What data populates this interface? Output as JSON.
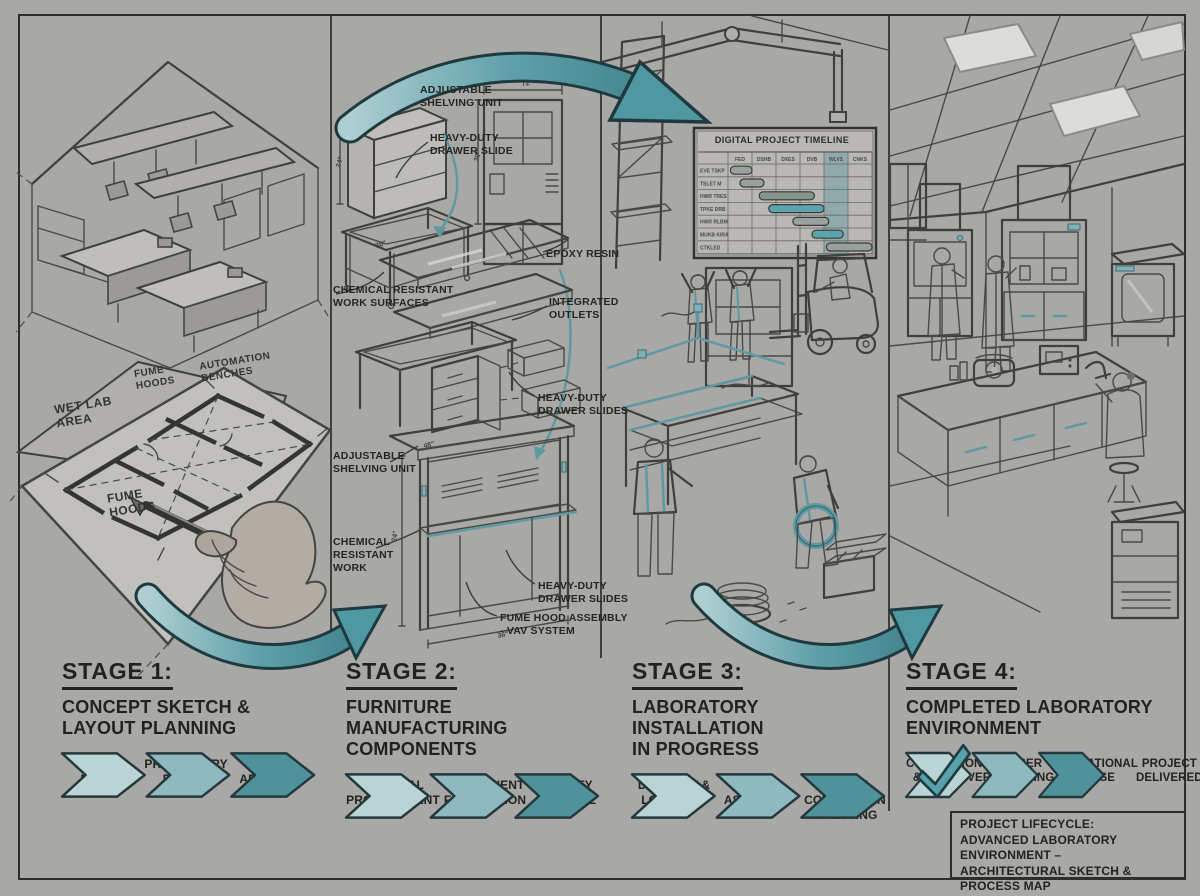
{
  "colors": {
    "background": "#a8a8a6",
    "ink": "#2b2a28",
    "teal": "#4f98a2",
    "teal_light": "#bad4d5",
    "teal_mid": "#8db9bf",
    "teal_dark": "#4f929c"
  },
  "stages": [
    {
      "title": "STAGE 1:",
      "subtitle": "CONCEPT SKETCH &\nLAYOUT PLANNING",
      "steps": [
        "CLIENT\nNEEDS",
        "PRELIMINARY\nDESIGN",
        "LAYDUT\nAPPROVAL"
      ]
    },
    {
      "title": "STAGE 2:",
      "subtitle": "FURNITURE MANUFACTURING\nCOMPONENTS",
      "steps": [
        "MATERIAL\nPROCURENENT",
        "COMPONENT\nFABRICATION",
        "GUALITY\nCONTROL"
      ]
    },
    {
      "title": "STAGE 3:",
      "subtitle": "LABORATORY INSTALLATION\nIN PROGRESS",
      "steps": [
        "DELIVERY &\nLOGISTICS",
        "ON-SITE\nASSEMBLY",
        "UTILITY\nCOKNECTION\n& TESTING"
      ]
    },
    {
      "title": "STAGE 4:",
      "subtitle": "COMPLETED LABORATORY\nENVIRONMENT",
      "steps": [
        "COMMISSIONING\n& HANDOVER",
        "USER\nTRAINING",
        "OPERATIONAL\nPHASE"
      ],
      "delivered": "PROJECT\nDELIVERED"
    }
  ],
  "panel1_labels": {
    "wet_lab": "WET LAB\nAREA",
    "fume_top": "FUME\nHOODS",
    "automation": "AUTOMATION\nBENCHES",
    "fume_lower": "FUME\nHOODS"
  },
  "stage2_annotations": [
    "ADJUSTABLE\nSHELVING UNIT",
    "HEAVY-DUTY\nDRAWER SLIDE",
    "EPOXY RESIN",
    "CHEMICAL RESISTANT\nWORK SURFACES",
    "INTEGRATED\nOUTLETS",
    "HEAVY-DUTY\nDRAWER SLIDES",
    "ADJUSTABLE\nSHELVING UNIT",
    "CHEMICAL\nRESISTANT\nWORK",
    "HEAVY-DUTY\nDRAWER SLIDES",
    "FUME HOOD ASSEMBLY\n- VAV SYSTEM"
  ],
  "dims": [
    "60\"",
    "24\"",
    "36\"",
    "72\"",
    "30\"",
    "48\"",
    "24\"",
    "36\""
  ],
  "gantt": {
    "title": "DIGITAL PROJECT TIMELINE",
    "columns": [
      "FED",
      "DSHB",
      "DXES",
      "DVB",
      "WLVS",
      "CNKS"
    ],
    "row_labels": [
      "EVE TSKP",
      "TSLET M",
      "HWR TRES",
      "TPKE DRB",
      "HWR RLBM",
      "MUKB KIRA",
      "CTKLED"
    ],
    "highlight_col": 4,
    "rows": [
      {
        "start": 0.1,
        "len": 0.9,
        "color": "#9aa09d"
      },
      {
        "start": 0.5,
        "len": 1.0,
        "color": "#9aa09d"
      },
      {
        "start": 1.3,
        "len": 2.3,
        "color": "#87968f"
      },
      {
        "start": 1.7,
        "len": 2.3,
        "color": "#5ba3ad"
      },
      {
        "start": 2.7,
        "len": 1.5,
        "color": "#9aa09d"
      },
      {
        "start": 3.5,
        "len": 1.3,
        "color": "#5ba3ad"
      },
      {
        "start": 4.1,
        "len": 1.9,
        "color": "#9aa09d"
      }
    ]
  },
  "title_block": {
    "line1": "PROJECT LIFECYCLE:",
    "line2": "ADVANCED LABORATORY ENVIRONMENT –",
    "line3": "ARCHITECTURAL SKETCH & PROCESS MAP",
    "footer_left": "VPCESTTN EE",
    "footer_right": "ESCHPYCES CHSZ"
  }
}
